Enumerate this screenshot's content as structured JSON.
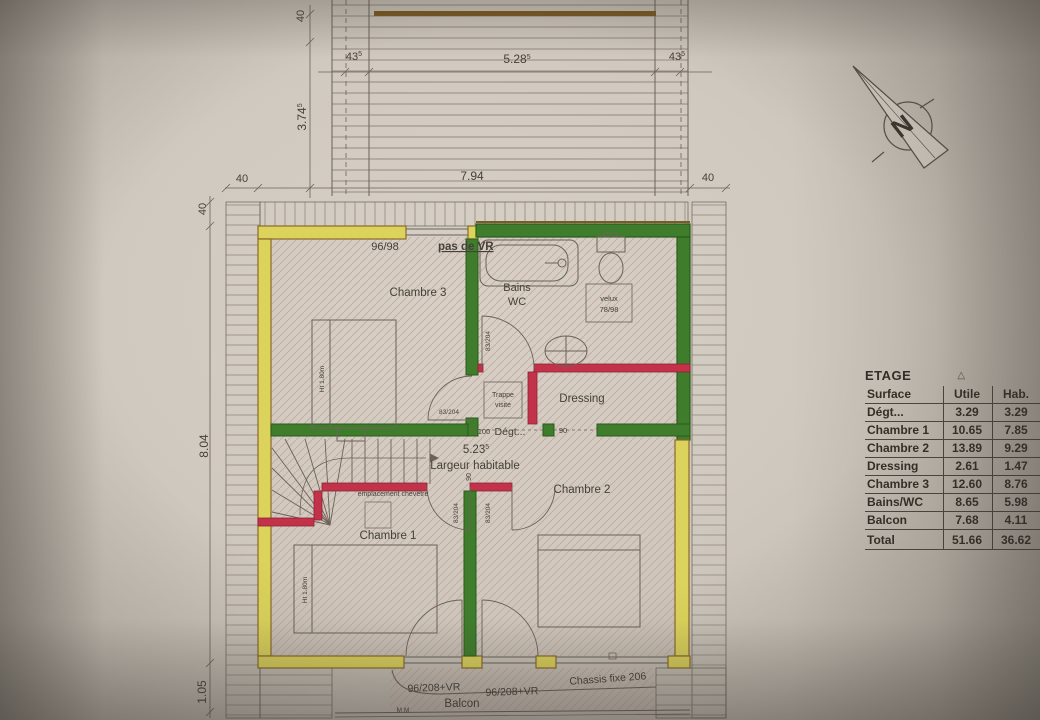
{
  "colors": {
    "paper": "#d3cdc3",
    "wall_yellow": "#dcd35c",
    "wall_yellow_edge": "#8a6a28",
    "wall_green": "#3f7d2c",
    "wall_green_edge": "#2a5c1c",
    "wall_red": "#c23349",
    "roof_ridge": "#7d5a22",
    "ink": "#45403a",
    "hatch": "#c9a79b"
  },
  "dims": {
    "d40_top_v": "40",
    "d43_left": "43",
    "d43_left_sup": "5",
    "d528": "5.28",
    "d528_sup": "5",
    "d43_right": "43",
    "d43_right_sup": "5",
    "d374": "3.74",
    "d374_sup": "5",
    "d794": "7.94",
    "d40_left": "40",
    "d40_right": "40",
    "d40_side": "40",
    "d804": "8.04",
    "d105": "1.05",
    "d523": "5.23",
    "d523_sup": "5",
    "d100": "100",
    "d90_corridor": "90",
    "d90_door": "90"
  },
  "rooms": {
    "chambre3": "Chambre 3",
    "bains": "Bains",
    "wc": "WC",
    "dressing": "Dressing",
    "degt": "Dégt...",
    "chambre2": "Chambre 2",
    "chambre1": "Chambre 1",
    "balcon": "Balcon"
  },
  "annotations": {
    "window_96_98": "96/98",
    "pas_de_vr": "pas de VR",
    "velux_l1": "velux",
    "velux_l2": "78/98",
    "trappe_l1": "Trappe",
    "trappe_l2": "visite",
    "chevetre": "emplacement chevêtre",
    "largeur": "Largeur habitable",
    "chassis": "Chassis fixe 206",
    "door_96_208_a": "96/208+VR",
    "door_96_208_b": "96/208+VR",
    "door_83_204_bains": "83/204",
    "door_83_204_ch3": "83/204",
    "door_83_204_ch1": "83/204",
    "door_83_204_ch2": "83/204",
    "ht180_ch3": "Ht 1.80m",
    "ht180_ch1": "Ht 1.80m",
    "mm_marks": "M M"
  },
  "compass": {
    "letter": "N"
  },
  "table": {
    "title": "ETAGE",
    "symbol": "△",
    "col_name": "Surface",
    "col_utile": "Utile",
    "col_hab": "Hab.",
    "rows": [
      {
        "name": "Dégt...",
        "utile": "3.29",
        "hab": "3.29"
      },
      {
        "name": "Chambre 1",
        "utile": "10.65",
        "hab": "7.85"
      },
      {
        "name": "Chambre 2",
        "utile": "13.89",
        "hab": "9.29"
      },
      {
        "name": "Dressing",
        "utile": "2.61",
        "hab": "1.47"
      },
      {
        "name": "Chambre 3",
        "utile": "12.60",
        "hab": "8.76"
      },
      {
        "name": "Bains/WC",
        "utile": "8.65",
        "hab": "5.98"
      },
      {
        "name": "Balcon",
        "utile": "7.68",
        "hab": "4.11"
      }
    ],
    "total": {
      "name": "Total",
      "utile": "51.66",
      "hab": "36.62"
    }
  }
}
